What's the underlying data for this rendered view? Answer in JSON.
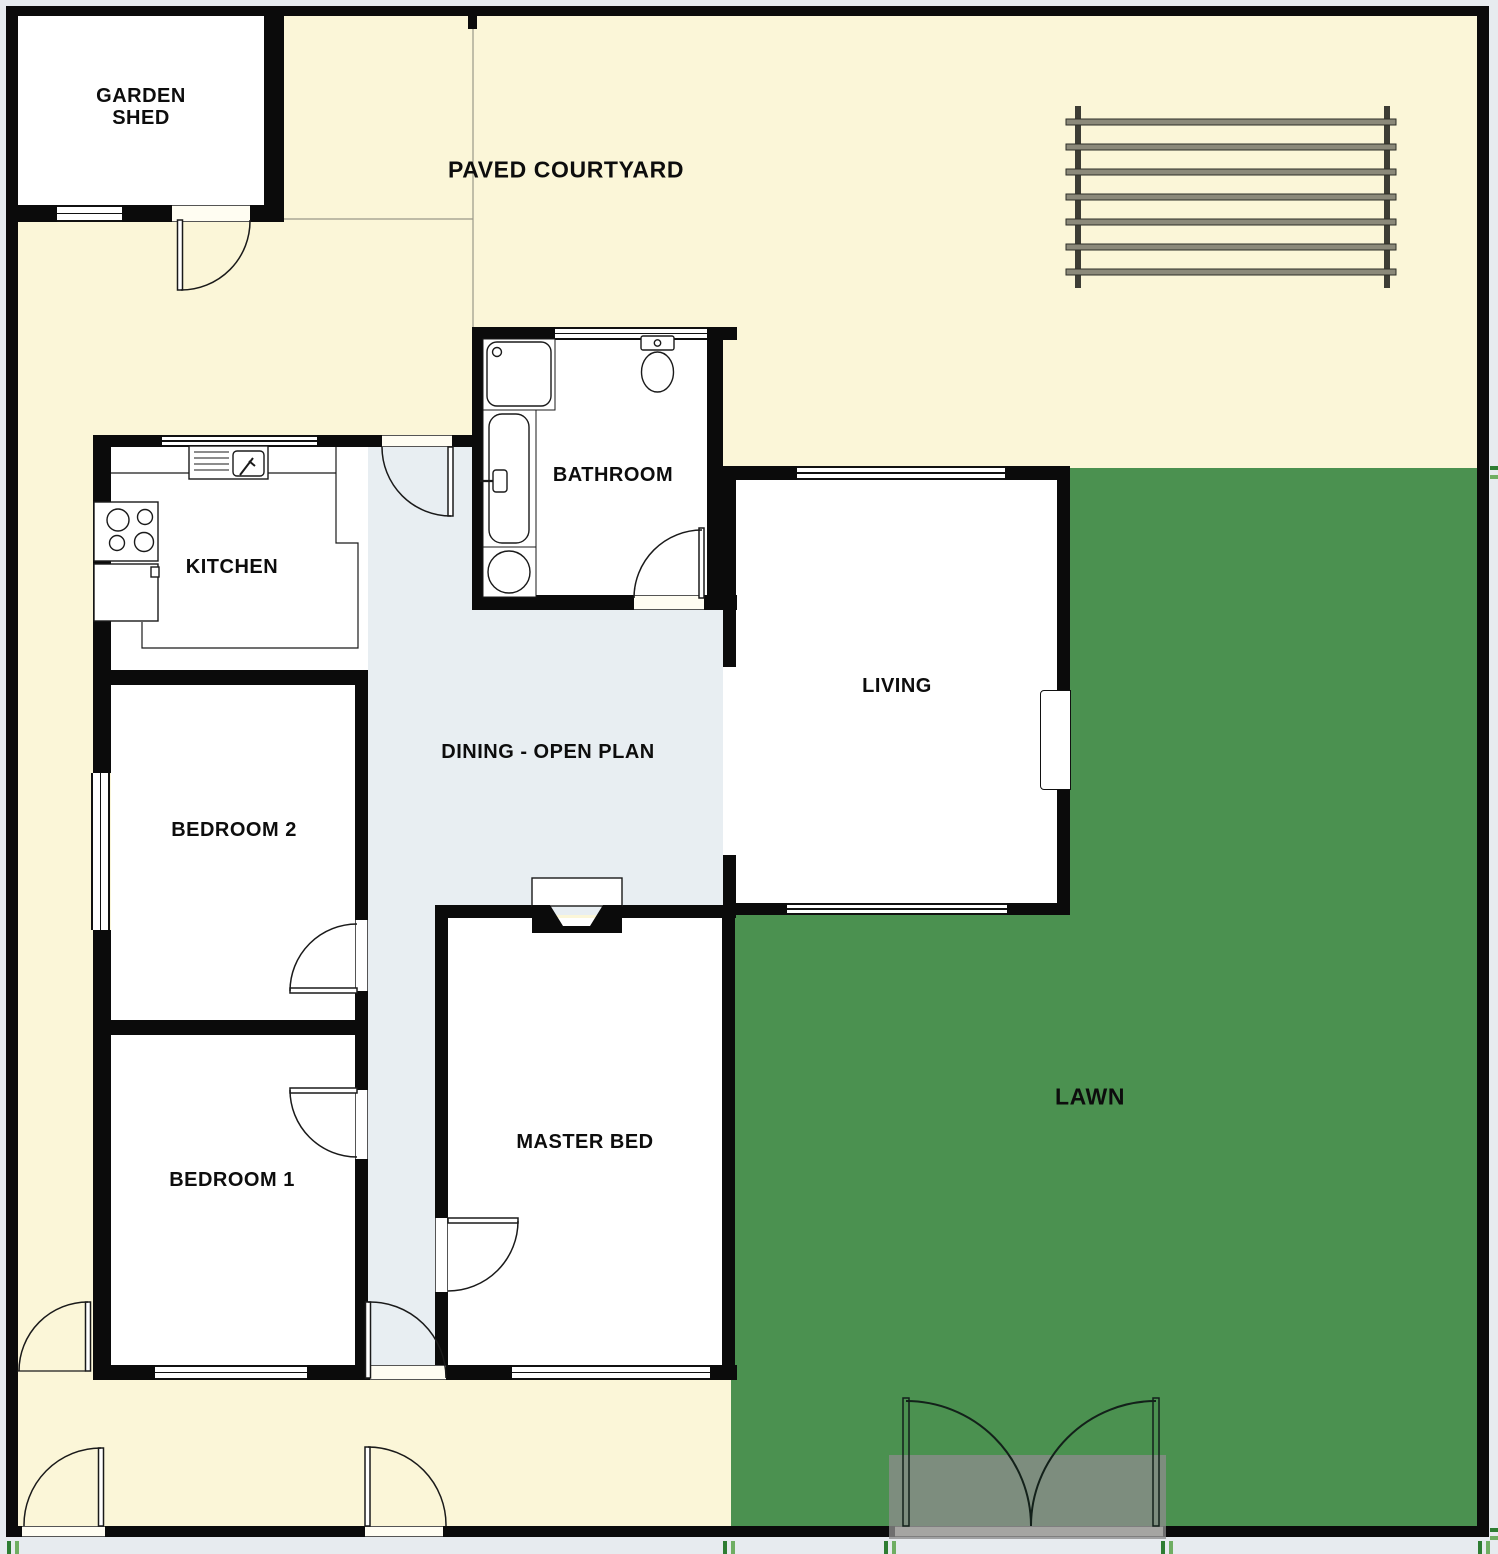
{
  "plan": {
    "labels": {
      "garden_shed": "GARDEN\nSHED",
      "paved_courtyard": "PAVED COURTYARD",
      "bathroom": "BATHROOM",
      "kitchen": "KITCHEN",
      "living": "LIVING",
      "dining": "DINING - OPEN PLAN",
      "bedroom2": "BEDROOM 2",
      "bedroom1": "BEDROOM 1",
      "master_bed": "MASTER BED",
      "lawn": "LAWN"
    },
    "colors": {
      "courtyard": "#FBF6D8",
      "lawn": "#4B9150",
      "dining": "#E8EEF2",
      "wall": "#0B0B0B",
      "room": "#FFFFFF",
      "outer": "#E7EBEF",
      "pad": "#8C8C8C",
      "pergola_bar": "#8B897A",
      "vegetation": "#2E7D32"
    },
    "fixtures": [
      "shower",
      "bathtub",
      "wash-basin",
      "toilet",
      "kitchen-sink",
      "stove",
      "oven",
      "counter",
      "fireplace",
      "pergola",
      "french-doors",
      "paved-step"
    ]
  }
}
